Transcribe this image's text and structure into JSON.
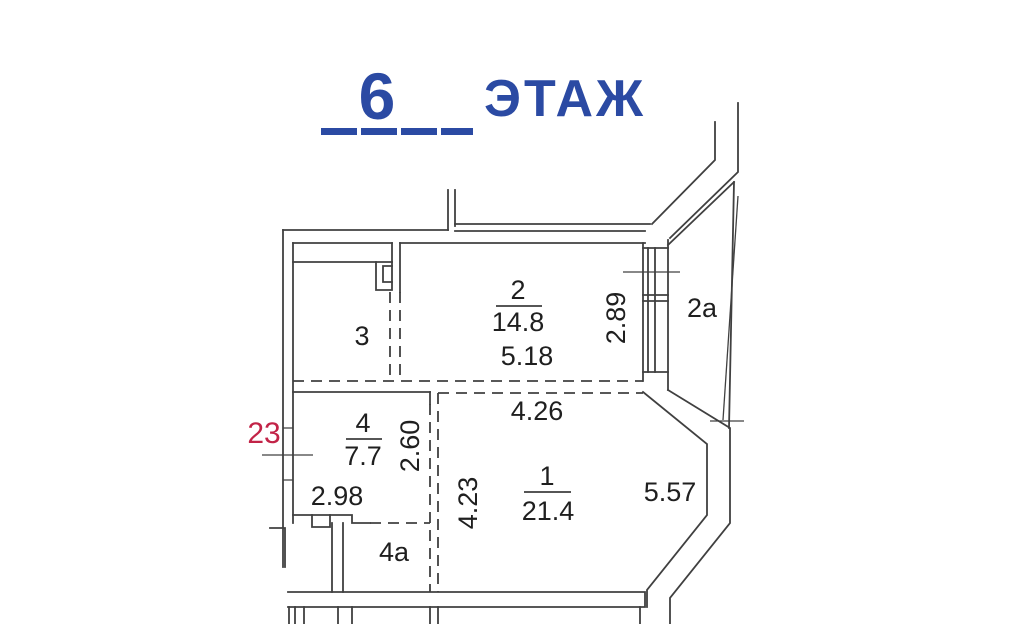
{
  "title": {
    "floor_number": "6",
    "floor_word": "ЭТАЖ"
  },
  "apartment": {
    "number": "23"
  },
  "rooms": {
    "r1": {
      "number": "1",
      "area": "21.4"
    },
    "r2": {
      "number": "2",
      "area": "14.8"
    },
    "r2a": {
      "number": "2a"
    },
    "r3": {
      "number": "3"
    },
    "r4": {
      "number": "4",
      "area": "7.7"
    },
    "r4a": {
      "number": "4a"
    }
  },
  "dimensions": {
    "room2_width": "5.18",
    "window_height": "2.89",
    "room1_width": "4.26",
    "room1_depth": "4.23",
    "bay_wall_length": "5.57",
    "room4_width": "2.98",
    "room4_depth": "2.60"
  },
  "colors": {
    "line": "#404040",
    "title_blue": "#2b4aa3",
    "apartment_red": "#c22347"
  }
}
